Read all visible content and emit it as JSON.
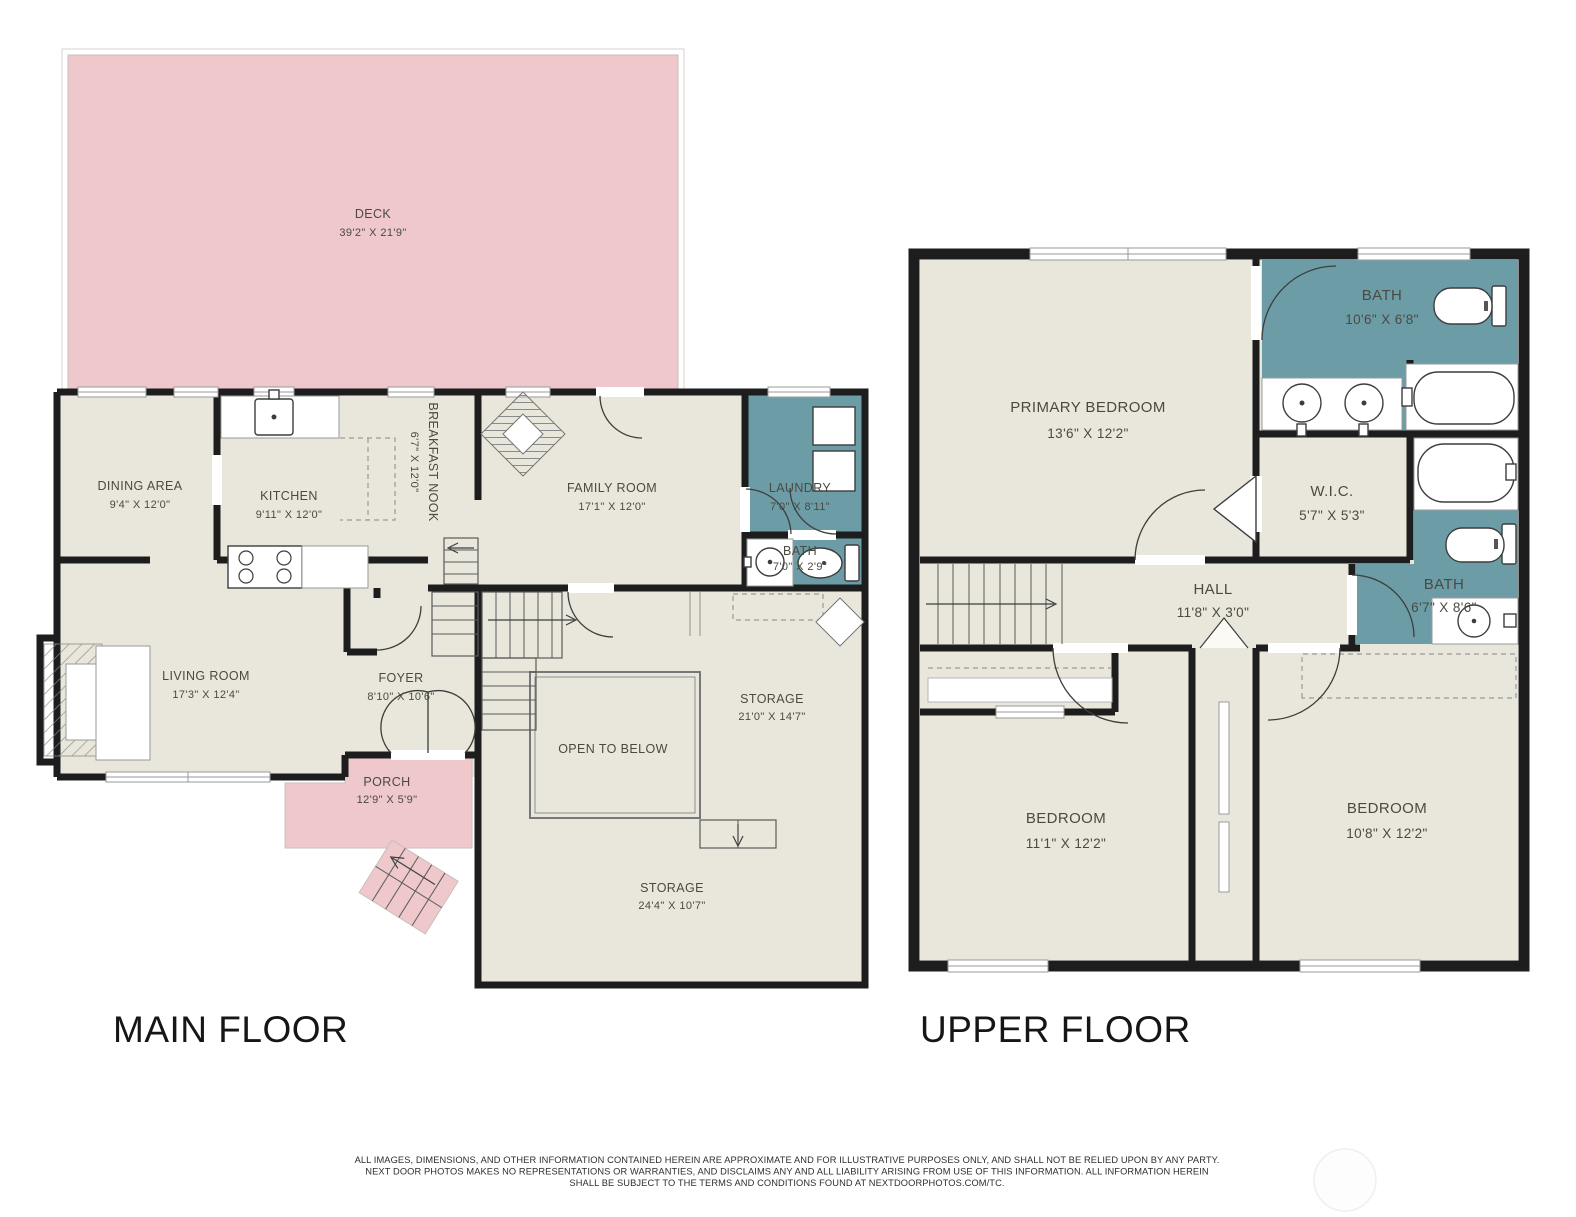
{
  "colors": {
    "paper": "#ffffff",
    "floor": "#e9e7db",
    "deck": "#eec8cb",
    "teal": "#6c9da6",
    "wall": "#1d1d1d",
    "thin": "#9a9a9a",
    "fixstroke": "#3d3d3d",
    "label": "#4a4a42",
    "title": "#161616",
    "disclaimer": "#2e2e2e",
    "logo": "#efefef"
  },
  "main_floor": {
    "title": "MAIN FLOOR",
    "rooms": {
      "deck": {
        "name": "DECK",
        "dims": "39'2\" X 21'9\""
      },
      "dining": {
        "name": "DINING AREA",
        "dims": "9'4\" X 12'0\""
      },
      "kitchen": {
        "name": "KITCHEN",
        "dims": "9'11\" X 12'0\""
      },
      "nook": {
        "name": "BREAKFAST NOOK",
        "dims": "6'7\" X 12'0\""
      },
      "family": {
        "name": "FAMILY ROOM",
        "dims": "17'1\" X 12'0\""
      },
      "laundry": {
        "name": "LAUNDRY",
        "dims": "7'0\" X 8'11\""
      },
      "bath": {
        "name": "BATH",
        "dims": "7'0\" X 2'9\""
      },
      "living": {
        "name": "LIVING ROOM",
        "dims": "17'3\" X 12'4\""
      },
      "foyer": {
        "name": "FOYER",
        "dims": "8'10\" X 10'6\""
      },
      "porch": {
        "name": "PORCH",
        "dims": "12'9\" X 5'9\""
      },
      "storage1": {
        "name": "STORAGE",
        "dims": "21'0\" X 14'7\""
      },
      "open": {
        "name": "OPEN TO BELOW"
      },
      "storage2": {
        "name": "STORAGE",
        "dims": "24'4\" X 10'7\""
      }
    }
  },
  "upper_floor": {
    "title": "UPPER FLOOR",
    "rooms": {
      "primary": {
        "name": "PRIMARY BEDROOM",
        "dims": "13'6\" X 12'2\""
      },
      "bath_top": {
        "name": "BATH",
        "dims": "10'6\" X 6'8\""
      },
      "wic": {
        "name": "W.I.C.",
        "dims": "5'7\" X 5'3\""
      },
      "bath_right": {
        "name": "BATH",
        "dims": "6'7\" X 8'6\""
      },
      "hall": {
        "name": "HALL",
        "dims": "11'8\" X 3'0\""
      },
      "bed_left": {
        "name": "BEDROOM",
        "dims": "11'1\" X 12'2\""
      },
      "bed_right": {
        "name": "BEDROOM",
        "dims": "10'8\" X 12'2\""
      }
    }
  },
  "footer": {
    "disclaimer_line1": "ALL IMAGES, DIMENSIONS, AND OTHER INFORMATION CONTAINED HEREIN ARE APPROXIMATE AND FOR ILLUSTRATIVE PURPOSES ONLY, AND SHALL NOT BE RELIED UPON BY ANY PARTY.",
    "disclaimer_line2": "NEXT DOOR PHOTOS MAKES NO REPRESENTATIONS OR WARRANTIES, AND DISCLAIMS ANY AND ALL LIABILITY ARISING FROM USE OF THIS INFORMATION. ALL INFORMATION HEREIN",
    "disclaimer_line3": "SHALL BE SUBJECT TO THE TERMS AND CONDITIONS FOUND AT NEXTDOORPHOTOS.COM/TC."
  }
}
